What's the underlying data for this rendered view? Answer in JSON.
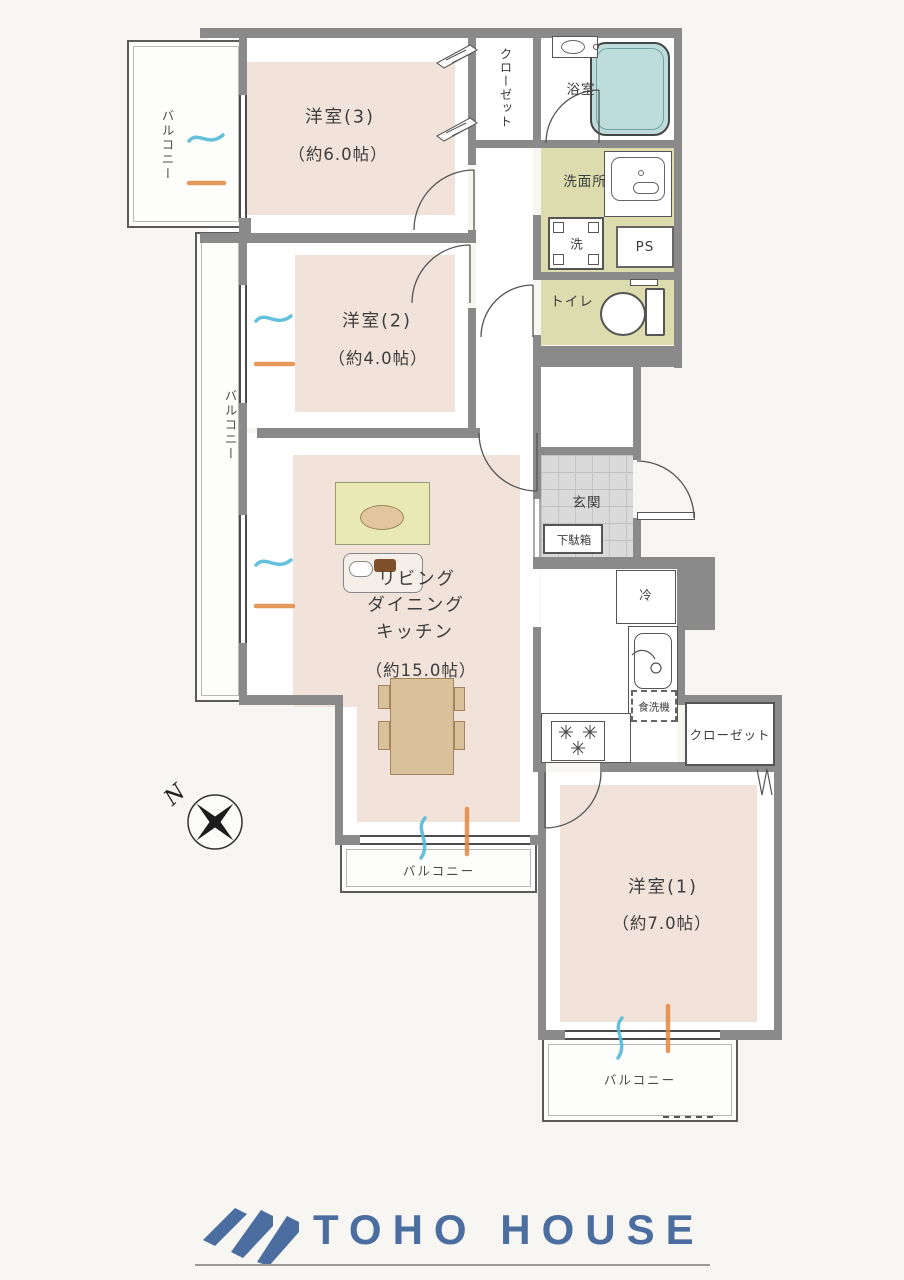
{
  "labels": {
    "room3": {
      "name": "洋室(3)",
      "size": "（約6.0帖）"
    },
    "room2": {
      "name": "洋室(2)",
      "size": "（約4.0帖）"
    },
    "room1": {
      "name": "洋室(1)",
      "size": "（約7.0帖）"
    },
    "ldk": {
      "l1": "リビング",
      "l2": "ダイニング",
      "l3": "キッチン",
      "size": "（約15.0帖）"
    },
    "bath": "浴室",
    "washroom": "洗面所",
    "laundry": "洗",
    "ps": "PS",
    "toilet": "トイレ",
    "genkan": "玄関",
    "shoe_cabinet": "下駄箱",
    "fridge": "冷",
    "dishwasher": "食洗機",
    "closet_top": "クローゼット",
    "closet_bottom": "クローゼット",
    "balcony_topleft": "バルコニー",
    "balcony_left": "バルコニー",
    "balcony_bottom": "バルコニー",
    "balcony_bottomright": "バルコニー",
    "compass_n": "N"
  },
  "branding": {
    "logo": "TOHO HOUSE"
  },
  "colors": {
    "wall": "#8a8a8a",
    "room_floor": "#f1e3d9",
    "wet_floor": "#dcdcae",
    "bathtub": "#bedcdc",
    "rug": "#e9e9b4",
    "table_wood": "#d8c19b",
    "vent_cool": "#53b9d9",
    "vent_warm": "#e2873f",
    "logo_blue": "#4c6da0"
  }
}
